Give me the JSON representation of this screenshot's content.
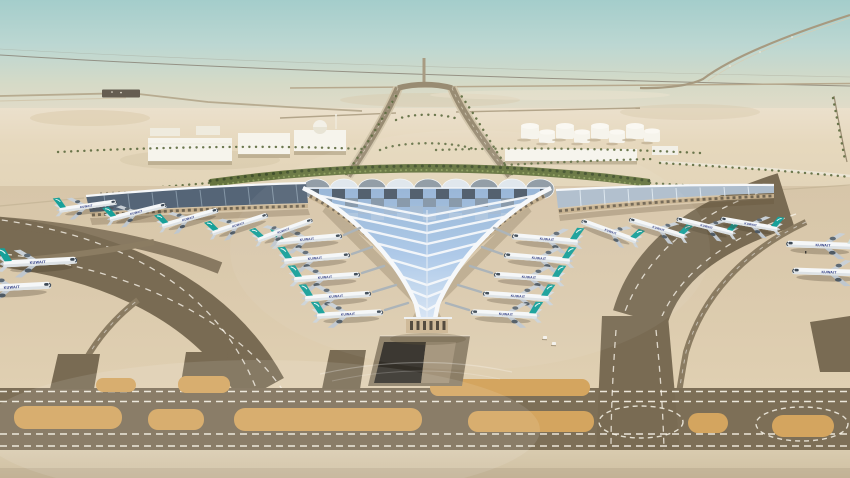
{
  "scene": {
    "type": "aerial-architectural-rendering",
    "subject": "Desert airport terminal with trefoil winged roof, aircraft at gates, taxiways in foreground",
    "airline_title": "KUWAIT"
  },
  "palette": {
    "sky_top": "#a4cdcb",
    "sky_haze": "#e5dcc8",
    "desert": "#e2d4b8",
    "apron": "#dbcaad",
    "taxiway_dark": "#7d6f57",
    "lane_dark": "#796b53",
    "island_orange": "#d4a55f",
    "marking_white": "#f7f3e8",
    "roof_blue": "#aac7e7",
    "roof_rib_white": "#f6f8fa",
    "roof_panel_dark": "#45525f",
    "wing_roof_dark": "#556577",
    "wing_roof_light": "#aebdcc",
    "facade_tan": "#c6b08e",
    "greenery": "#66743f",
    "fuselage_white": "#f5f7f8",
    "tail_teal": "#17a099",
    "tail_pale": "#cfe0dd",
    "titles_blue": "#1f2d7a"
  }
}
